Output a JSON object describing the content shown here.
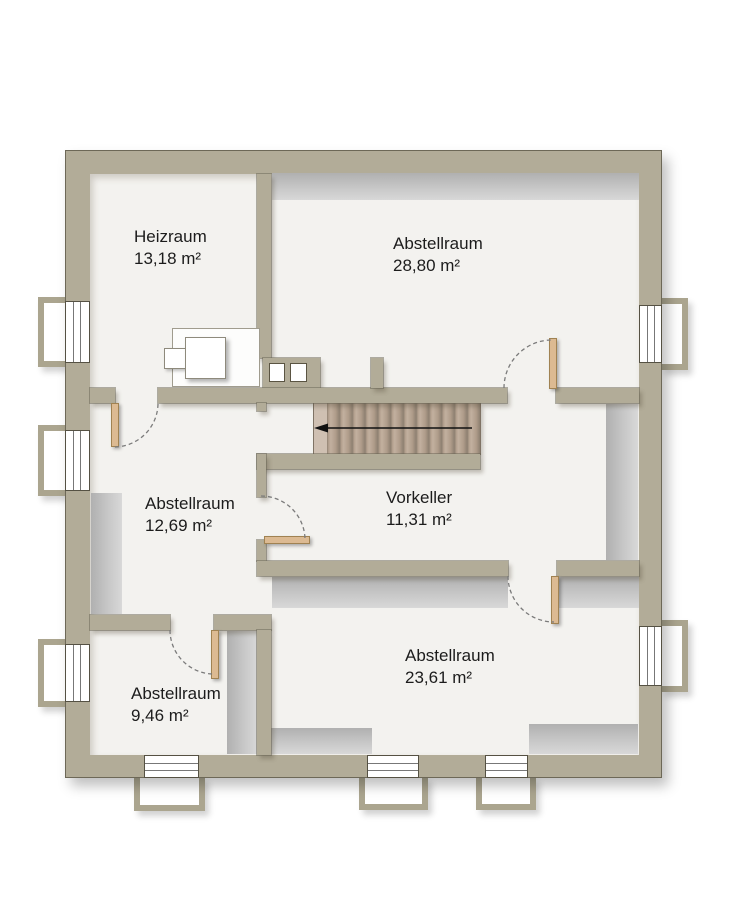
{
  "plan": {
    "type": "floor-plan",
    "language": "de",
    "rooms": [
      {
        "name": "Heizraum",
        "area": "13,18 m²"
      },
      {
        "name": "Abstellraum",
        "area": "28,80 m²"
      },
      {
        "name": "Abstellraum",
        "area": "12,69 m²"
      },
      {
        "name": "Vorkeller",
        "area": "11,31 m²"
      },
      {
        "name": "Abstellraum",
        "area": "23,61 m²"
      },
      {
        "name": "Abstellraum",
        "area": "9,46 m²"
      }
    ],
    "stairs": {
      "treads": 13,
      "arrow_direction": "left"
    },
    "counts": {
      "windows": 8,
      "window_wells": 8,
      "doors": 5,
      "chimney_flues": 2
    },
    "colors": {
      "wall": "#b2ac98",
      "floor": "#f3f2ef",
      "stair_tread": "#b5a290",
      "door_leaf": "#dcba92",
      "shading_band": "#c9c9c9",
      "arrow": "#111111",
      "background": "#ffffff"
    }
  }
}
